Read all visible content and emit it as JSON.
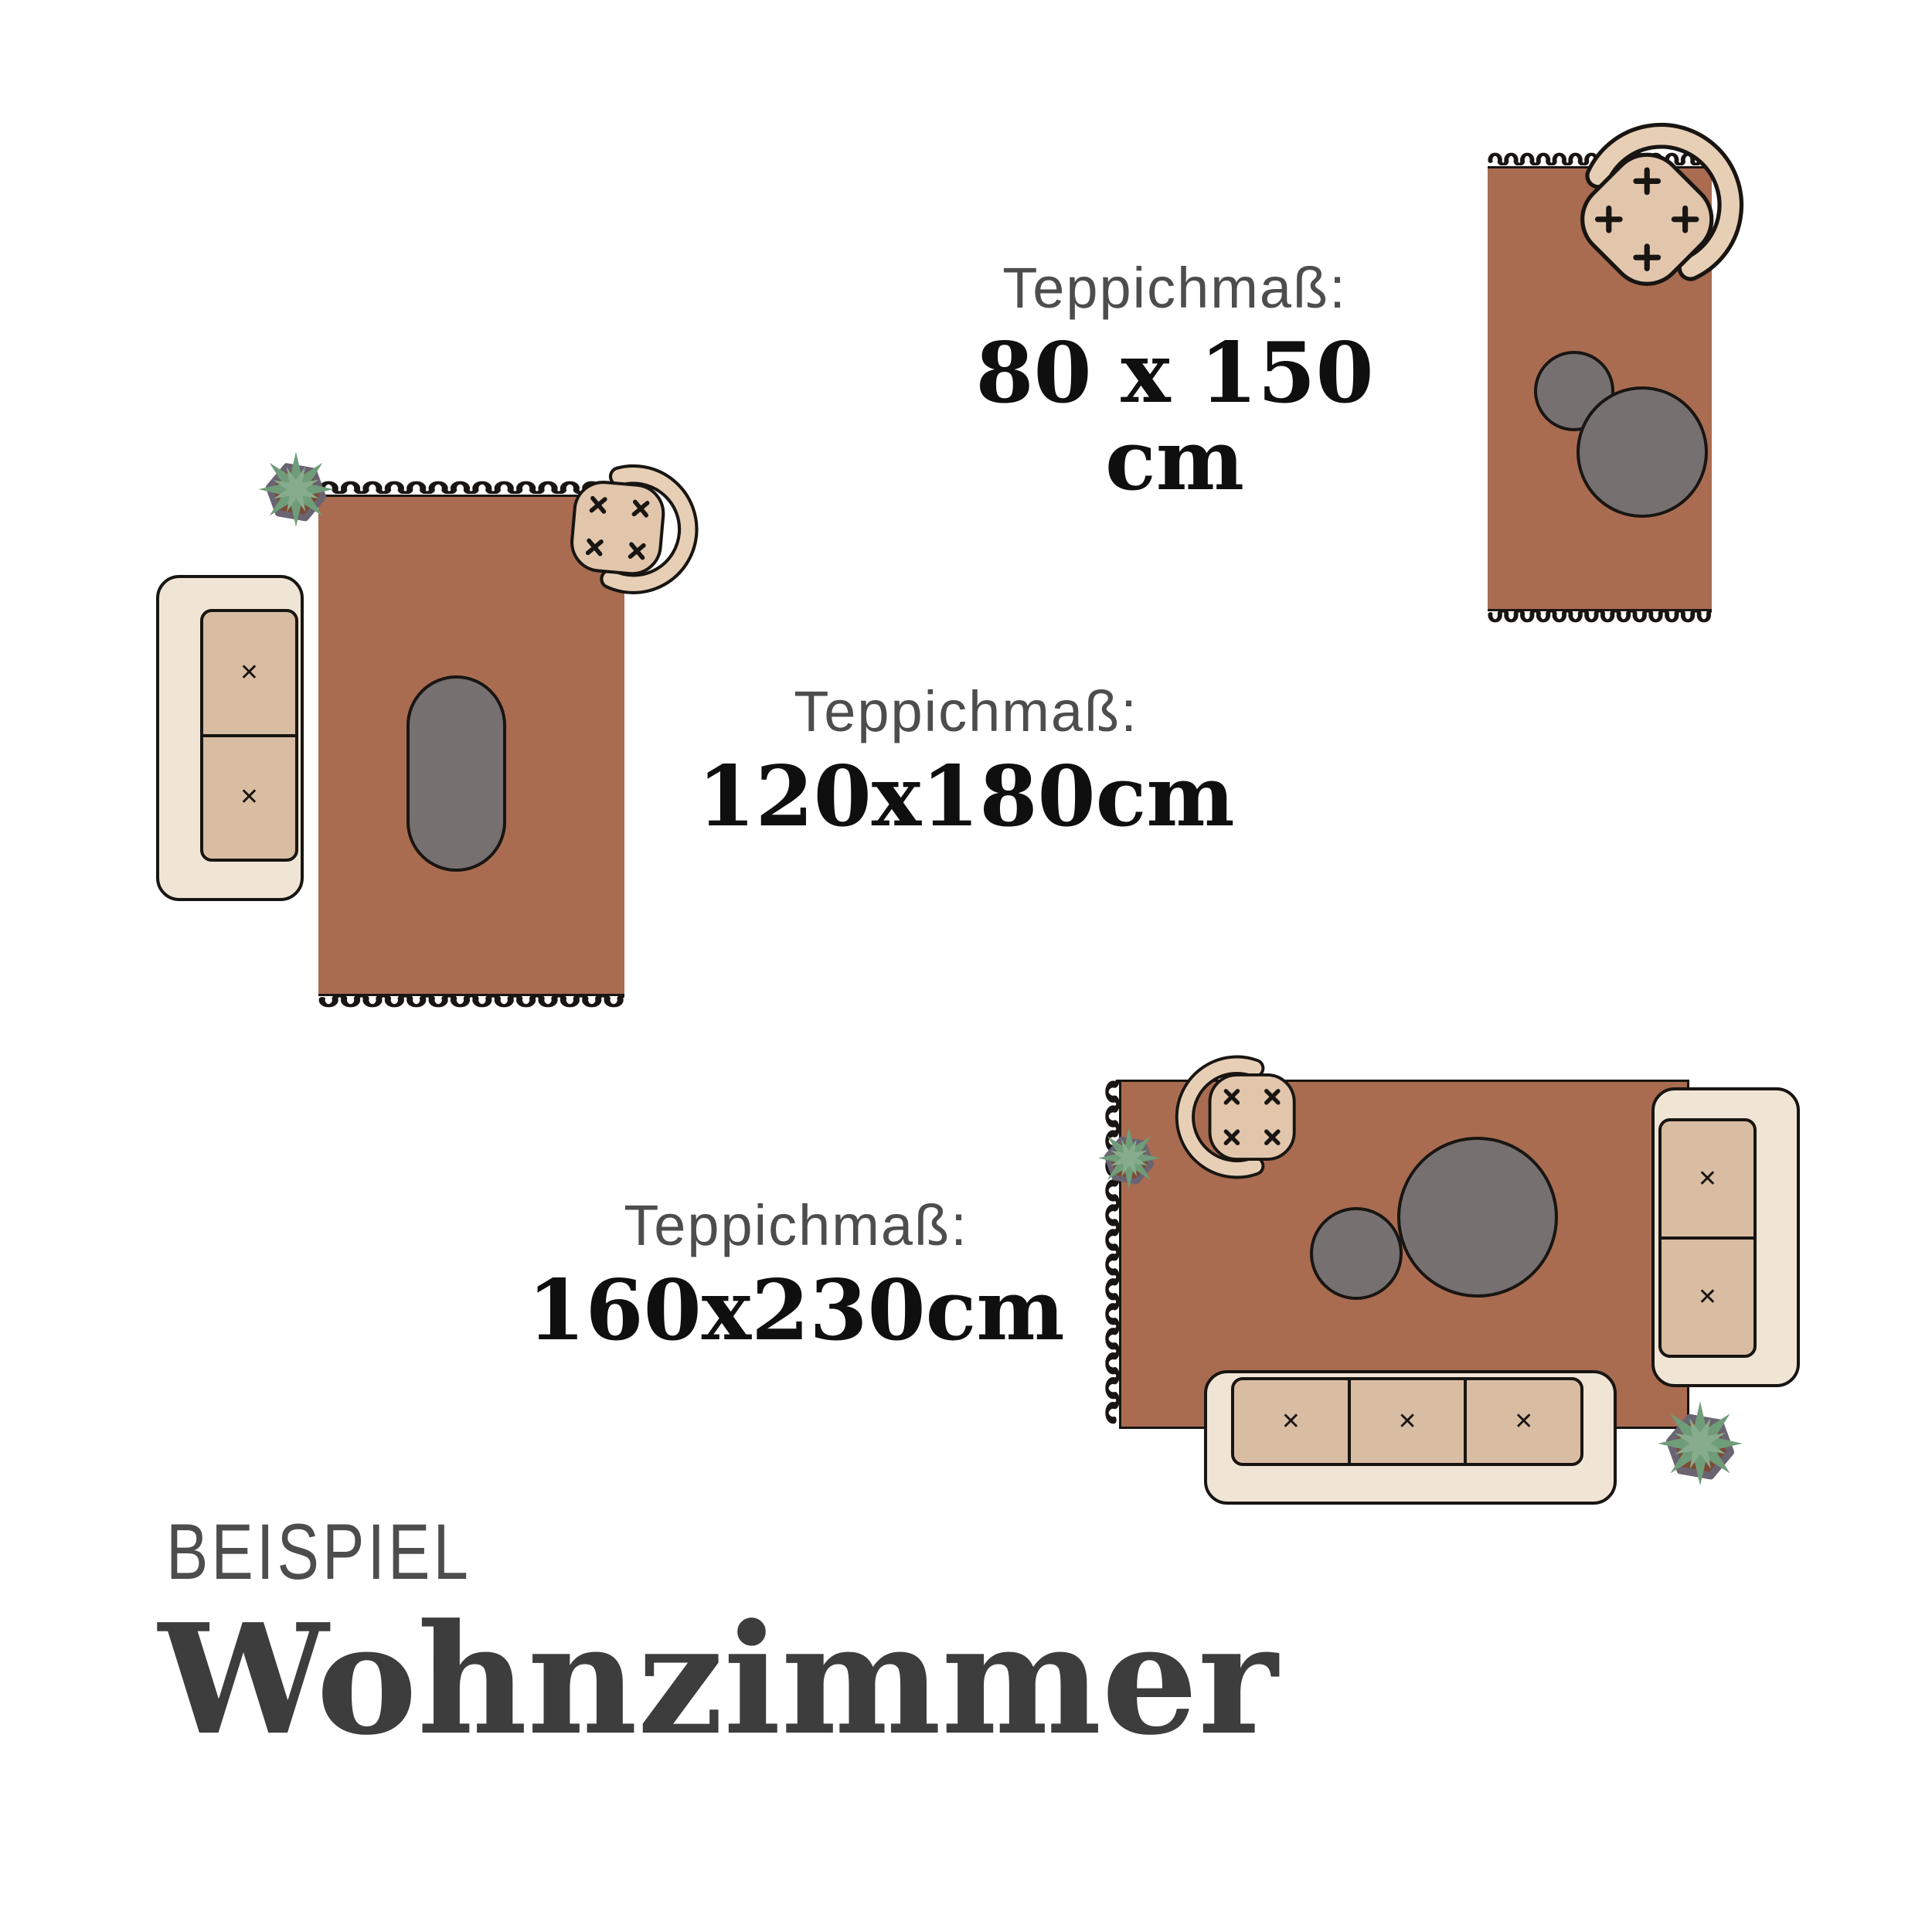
{
  "colors": {
    "bg": "#ffffff",
    "rug": "#a96c51",
    "ink": "#181512",
    "cream": "#f0e5d5",
    "cushion": "#d9bda3",
    "seatback": "#e7cfb6",
    "seat": "#e2c6ac",
    "table": "#767071",
    "pot_ring": "#6a6472",
    "pot_soil": "#7b4b34",
    "leaf_dark": "#6f9d79",
    "leaf_light": "#87ac8d",
    "text_gray": "#4d4d4d",
    "text_dark": "#3d3d3d",
    "text_black": "#0f0f0f"
  },
  "marks": {
    "cushion": "✕"
  },
  "sections": {
    "size_80x150": {
      "heading": "Teppichmaß:",
      "value": "80 x 150 cm"
    },
    "size_120x180": {
      "heading": "Teppichmaß:",
      "value": "120x180cm"
    },
    "size_160x230": {
      "heading": "Teppichmaß:",
      "value": "160x230cm"
    },
    "footer": {
      "eyebrow": "BEISPIEL",
      "title": "Wohnzimmer"
    }
  }
}
